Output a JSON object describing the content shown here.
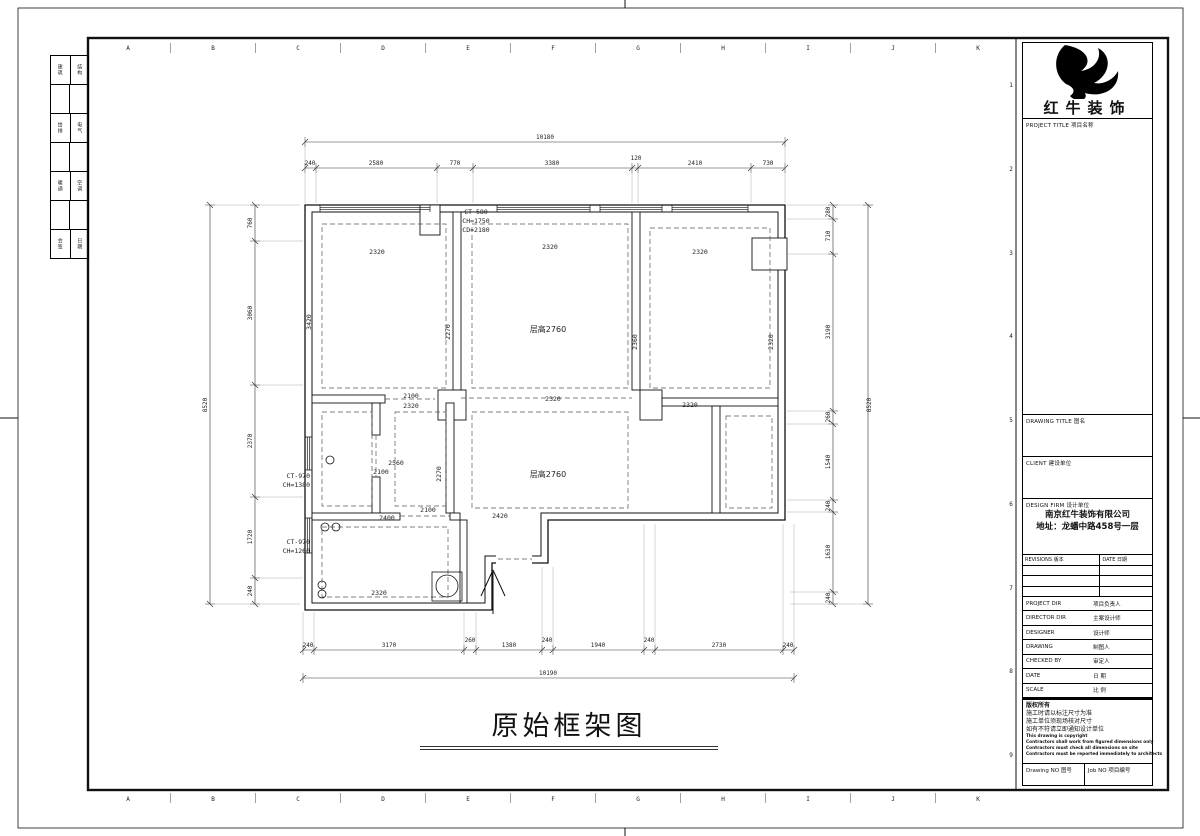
{
  "title_block": {
    "brand": "红牛装饰",
    "labels": {
      "project_title": {
        "en": "PROJECT TITLE",
        "zh": "项目名称"
      },
      "drawing_title": {
        "en": "DRAWING TITLE",
        "zh": "图名"
      },
      "client": {
        "en": "CLIENT",
        "zh": "建设单位"
      },
      "design_firm": {
        "en": "DESIGN FIRM",
        "zh": "设计单位"
      },
      "revisions": {
        "en": "REVISIONS",
        "zh": "版本"
      },
      "rev_date": {
        "en": "DATE",
        "zh": "日期"
      },
      "drawing_no": {
        "en": "Drawing NO",
        "zh": "图号"
      },
      "job_no": {
        "en": "Job NO",
        "zh": "项目编号"
      }
    },
    "firm_name": "南京红牛装饰有限公司",
    "firm_addr": "地址：龙蟠中路458号一层",
    "persons": [
      {
        "en": "PROJECT DIR",
        "zh": "项目负责人"
      },
      {
        "en": "DIRECTOR DIR",
        "zh": "主案设计师"
      },
      {
        "en": "DESIGNER",
        "zh": "设计师"
      },
      {
        "en": "DRAWING",
        "zh": "制图人"
      },
      {
        "en": "CHECKED BY",
        "zh": "审定人"
      },
      {
        "en": "DATE",
        "zh": "日  期"
      },
      {
        "en": "SCALE",
        "zh": "比  例"
      }
    ],
    "copyright": [
      "版权所有",
      "施工时请以标注尺寸为准",
      "施工单位须现场核对尺寸",
      "如有不符请立即通知设计单位",
      "This drawing is copyright",
      "Contractors shall work from figured dimensions only",
      "Contractors must check all dimensions on site",
      "Contractors must be reported immediately to architects"
    ]
  },
  "rulers": {
    "letters": [
      "A",
      "B",
      "C",
      "D",
      "E",
      "F",
      "G",
      "H",
      "I",
      "J",
      "K"
    ],
    "right_numbers": [
      "1",
      "2",
      "3",
      "4",
      "5",
      "6",
      "7",
      "8",
      "9"
    ]
  },
  "side_strip": {
    "rows": [
      [
        "建筑",
        "结构"
      ],
      [
        "给排",
        "电气"
      ],
      [
        "暖通",
        "空调"
      ],
      [
        "会签",
        "日期"
      ]
    ]
  },
  "plan": {
    "title": "原始框架图",
    "floor_height_label": "层高2760",
    "dims": {
      "top_total": "10180",
      "top_segs": [
        "240",
        "2580",
        "770",
        "3380",
        "120",
        "2410",
        "730"
      ],
      "bottom_segs": [
        "240",
        "3170",
        "260",
        "1380",
        "240",
        "1940",
        "240",
        "2730",
        "240"
      ],
      "bottom_total": "10190",
      "left_total": "8520",
      "left_segs": [
        "760",
        "3060",
        "2370",
        "1720",
        "240"
      ],
      "right_total": "8520",
      "right_segs": [
        "280",
        "710",
        "3190",
        "260",
        "1540",
        "240",
        "1630",
        "240"
      ],
      "rooms": {
        "tl_top": "2320",
        "tl_left": "3420",
        "tl_right": "2270",
        "living_top": "2320",
        "living_right": "2360",
        "living_bottom": "2320",
        "tr_top": "2320",
        "tr_right": "2320",
        "tr_bottom": "2320",
        "door_top": "2100",
        "door_bottom": "2320",
        "bath_w": "2560",
        "bath_door": "2100",
        "bath_right": "2270",
        "kit_top": "2400",
        "kit_door": "2100",
        "hall_w": "2420",
        "kit_bottom": "2320"
      },
      "windows": {
        "ct_top": [
          "CT-580",
          "CH=1750",
          "CD=2180"
        ],
        "ct_left1": [
          "CT-970",
          "CH=1380"
        ],
        "ct_left2": [
          "CT-970",
          "CH=1260"
        ]
      }
    }
  }
}
